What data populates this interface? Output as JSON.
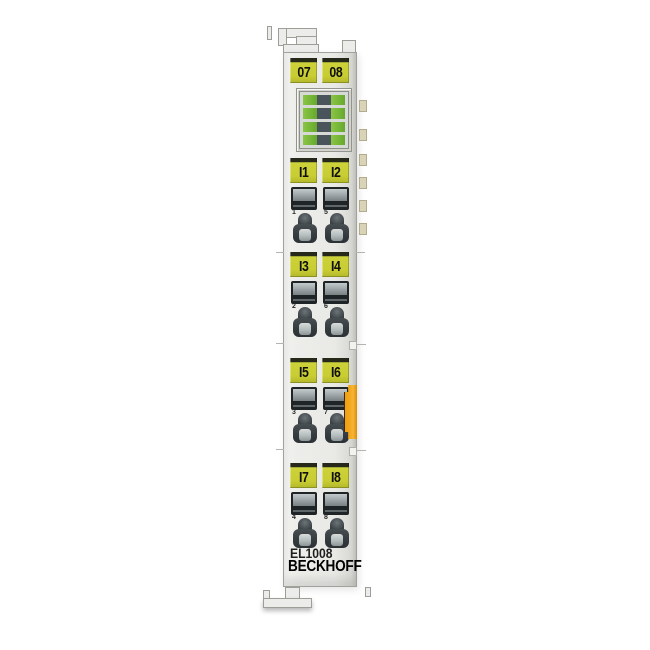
{
  "product": {
    "model": "EL1008",
    "brand": "BECKHOFF"
  },
  "top_labels": [
    "07",
    "08"
  ],
  "led_block": {
    "rows": 4,
    "leds_per_row": 2
  },
  "channel_groups": [
    {
      "left_label": "I1",
      "right_label": "I2",
      "left_number": "1",
      "right_number": "5"
    },
    {
      "left_label": "I3",
      "right_label": "I4",
      "left_number": "2",
      "right_number": "6"
    },
    {
      "left_label": "I5",
      "right_label": "I6",
      "left_number": "3",
      "right_number": "7"
    },
    {
      "left_label": "I7",
      "right_label": "I8",
      "left_number": "4",
      "right_number": "8"
    }
  ],
  "side_contacts": {
    "count": 6
  },
  "colors": {
    "label_yellow": "#c8cd33",
    "label_top_stripe": "#26291a",
    "led_green": "#7abc34",
    "led_center_dark": "#49555a",
    "latch_orange": "#f0a01d",
    "side_contact_tan": "#d9d3b7",
    "body_gray": "#ececea",
    "clamp_dark": "#23282b"
  }
}
